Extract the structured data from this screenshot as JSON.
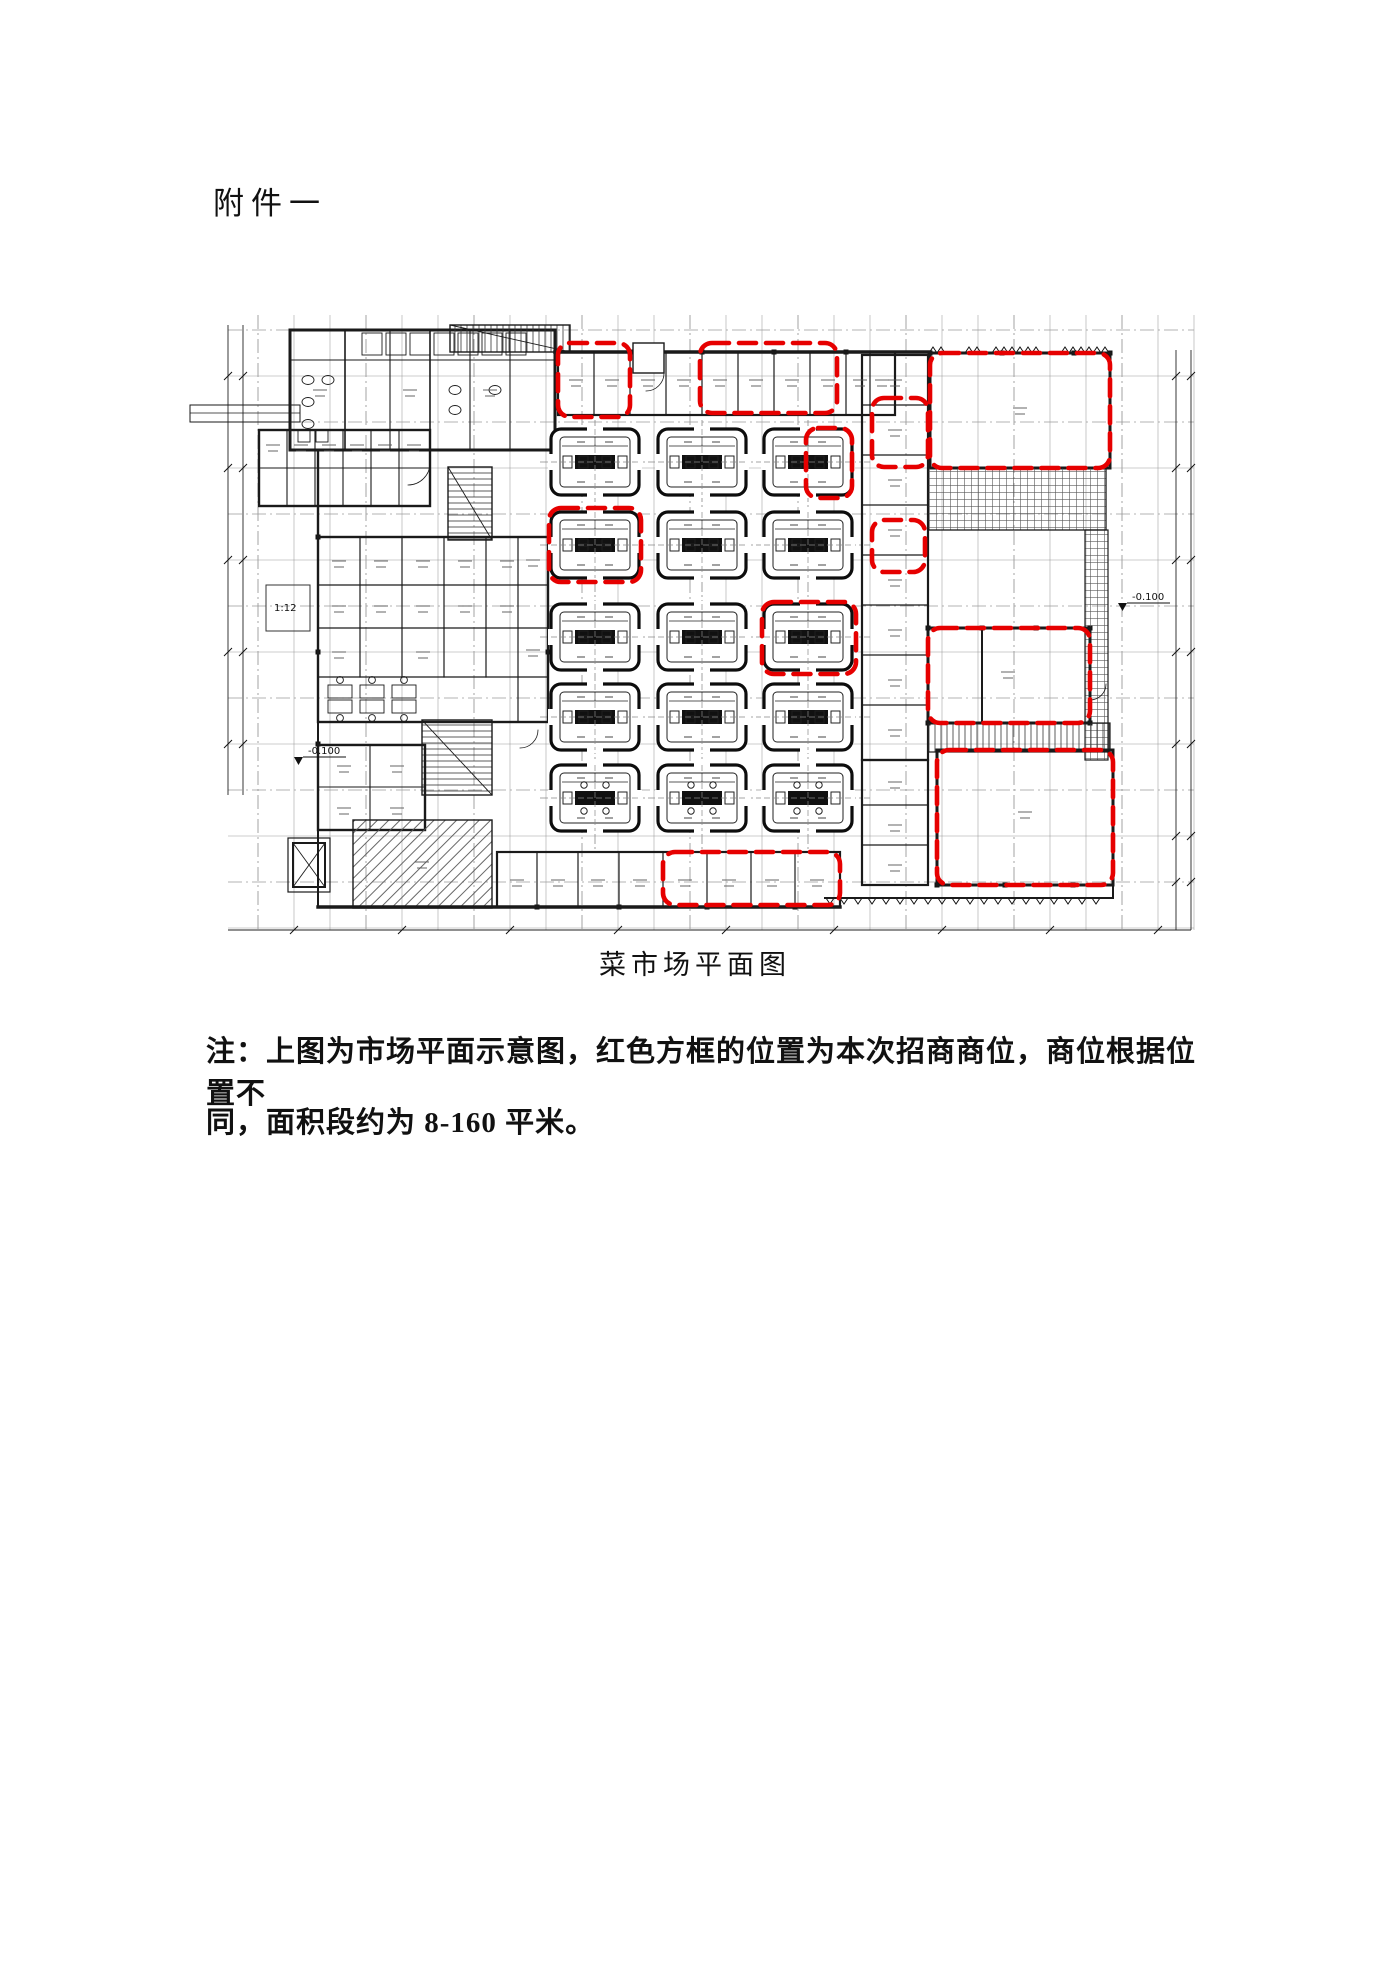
{
  "document": {
    "title": "附件一",
    "figure": {
      "caption": "菜市场平面图"
    },
    "note": {
      "line1": "注：上图为市场平面示意图，红色方框的位置为本次招商商位，商位根据位置不",
      "line2": "同，面积段约为 8-160 平米。"
    }
  },
  "colors": {
    "paper": "#ffffff",
    "line": "#1a1a1a",
    "grid": "#9a9a9a",
    "highlight": "#e60000"
  },
  "plan": {
    "islands": {
      "col_centers": [
        425,
        532,
        638
      ],
      "row_centers": [
        232,
        315,
        407,
        487,
        568
      ],
      "width": 88,
      "height": 66
    },
    "highlights": [
      {
        "x": 388,
        "y": 113,
        "w": 72,
        "h": 74
      },
      {
        "x": 530,
        "y": 113,
        "w": 137,
        "h": 70
      },
      {
        "x": 760,
        "y": 123,
        "w": 180,
        "h": 115
      },
      {
        "x": 702,
        "y": 168,
        "w": 56,
        "h": 69
      },
      {
        "x": 702,
        "y": 290,
        "w": 53,
        "h": 52
      },
      {
        "x": 379,
        "y": 278,
        "w": 92,
        "h": 74
      },
      {
        "x": 636,
        "y": 198,
        "w": 46,
        "h": 70
      },
      {
        "x": 592,
        "y": 372,
        "w": 94,
        "h": 72
      },
      {
        "x": 758,
        "y": 398,
        "w": 162,
        "h": 95
      },
      {
        "x": 767,
        "y": 520,
        "w": 176,
        "h": 135
      },
      {
        "x": 493,
        "y": 622,
        "w": 177,
        "h": 53
      }
    ],
    "markers": [
      {
        "text": "-0.100",
        "x": 138,
        "y": 524
      },
      {
        "text": "-0.100",
        "x": 962,
        "y": 370
      },
      {
        "text": "1:12",
        "x": 104,
        "y": 381
      }
    ]
  }
}
